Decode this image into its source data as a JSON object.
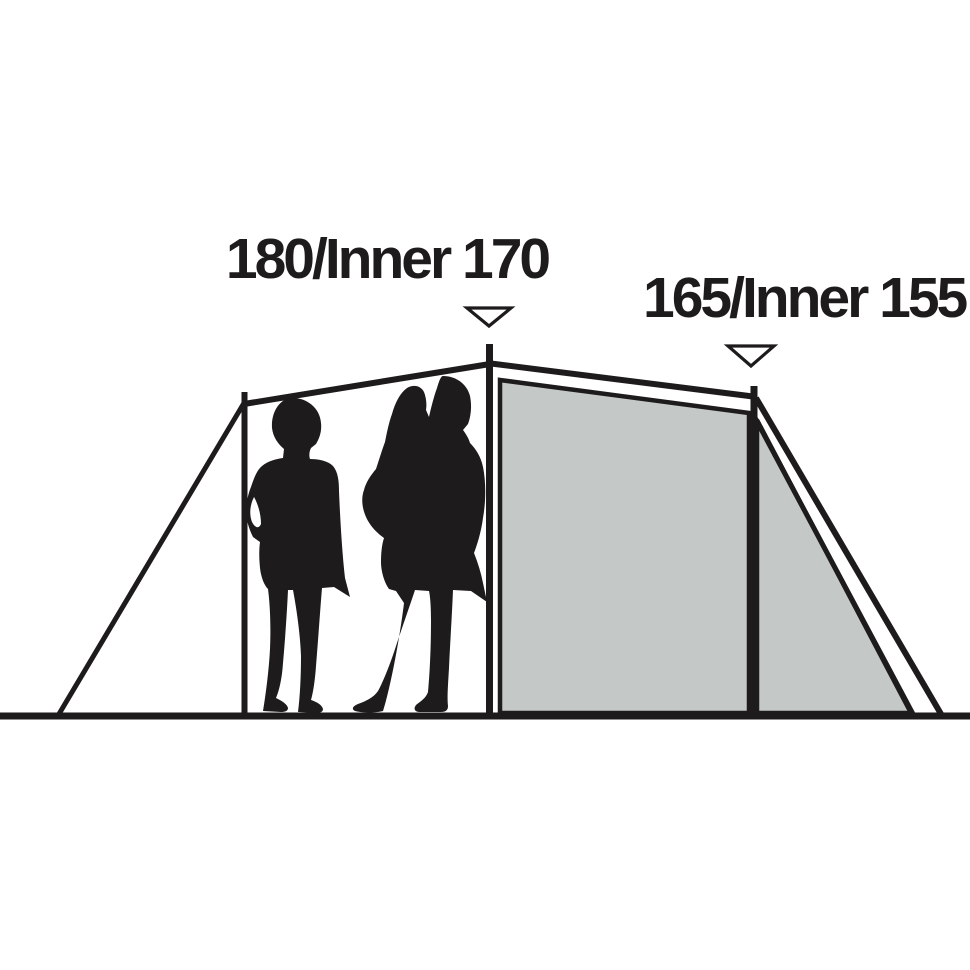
{
  "diagram": {
    "name": "tent-side-profile-height-diagram",
    "labels": {
      "front_peak": "180/Inner 170",
      "rear_peak": "165/Inner 155"
    },
    "markers": [
      "down-triangle-marker",
      "down-triangle-marker"
    ],
    "colors": {
      "ink": "#1d1b1b",
      "panel": "#c4c8c6",
      "bg": "#ffffff"
    }
  }
}
